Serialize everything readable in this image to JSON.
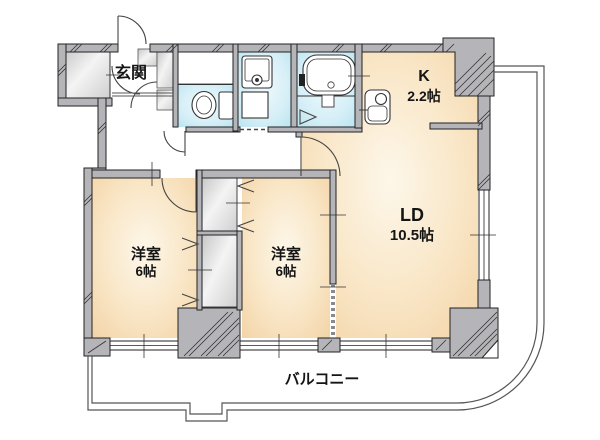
{
  "type": "floor-plan",
  "rooms": [
    {
      "id": "entrance",
      "label": "玄関"
    },
    {
      "id": "kitchen",
      "label": "K",
      "size": "2.2帖"
    },
    {
      "id": "living-dining",
      "label": "LD",
      "size": "10.5帖"
    },
    {
      "id": "bedroom-left",
      "label": "洋室",
      "size": "6帖"
    },
    {
      "id": "bedroom-center",
      "label": "洋室",
      "size": "6帖"
    },
    {
      "id": "balcony",
      "label": "バルコニー"
    }
  ],
  "colors": {
    "wall_fill": "#b5b5b9",
    "room_fill": "#f3d3a6",
    "wet_area_fill": "#bce4f0",
    "closet_fill": "#d9d9d9",
    "outline": "#222222",
    "background": "#ffffff"
  }
}
